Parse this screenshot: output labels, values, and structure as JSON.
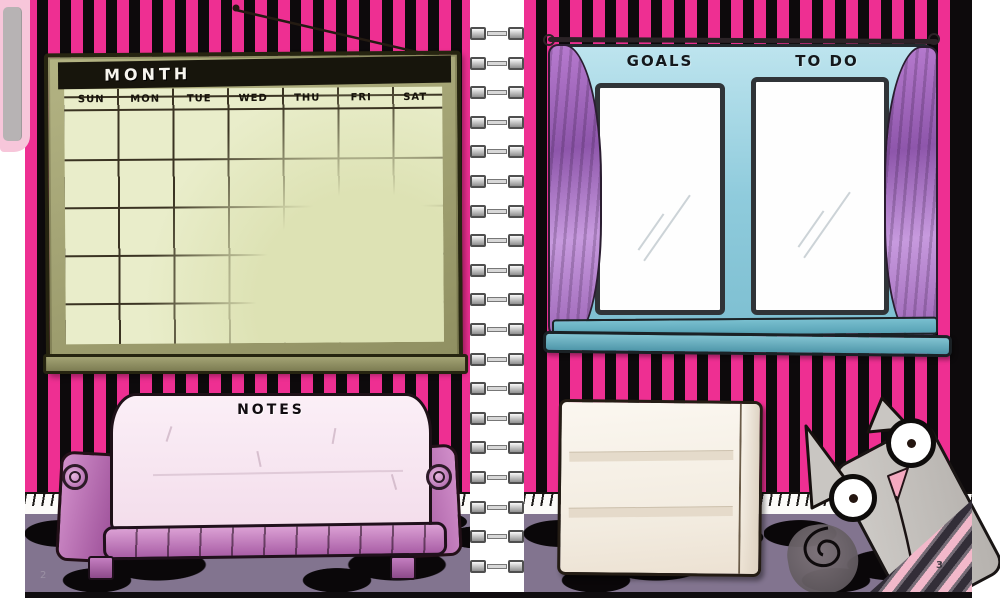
{
  "spread": {
    "left_page_number": "2",
    "right_page_number": "3"
  },
  "binding": {
    "ring_count": 19
  },
  "calendar": {
    "title": "MONTH",
    "days": [
      "SUN",
      "MON",
      "TUE",
      "WED",
      "THU",
      "FRI",
      "SAT"
    ],
    "week_rows": 5
  },
  "notes_couch": {
    "label": "NOTES"
  },
  "window": {
    "goals_label": "GOALS",
    "todo_label": "TO DO"
  },
  "colors": {
    "stripe_pink": "#ee2f92",
    "stripe_black": "#0d0a0c",
    "calendar_frame_olive": "#9b9b6d",
    "calendar_paper_green": "#e9edca",
    "window_blue": "#8fcbdc",
    "curtain_purple": "#a864c2",
    "couch_pink": "#f8ecf5",
    "couch_trim_purple": "#b969b3",
    "carpet_purple": "#82748f",
    "cat_gray": "#c6c3bf"
  }
}
